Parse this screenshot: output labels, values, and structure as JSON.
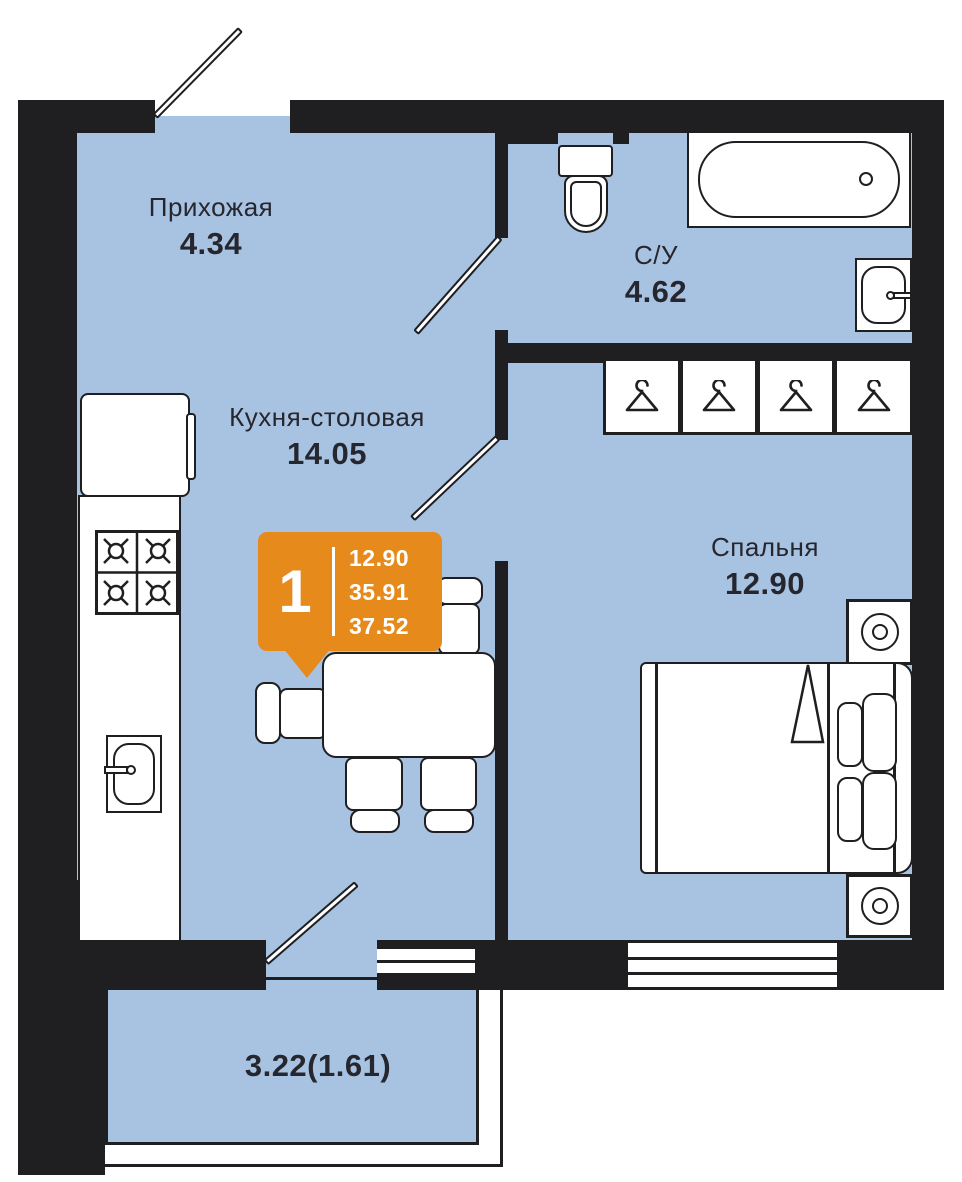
{
  "badge": {
    "rooms_count": "1",
    "values": [
      "12.90",
      "35.91",
      "37.52"
    ]
  },
  "rooms": {
    "hallway": {
      "name": "Прихожая",
      "area": "4.34"
    },
    "kitchen": {
      "name": "Кухня-столовая",
      "area": "14.05"
    },
    "bathroom": {
      "name": "С/У",
      "area": "4.62"
    },
    "bedroom": {
      "name": "Спальня",
      "area": "12.90"
    },
    "balcony": {
      "area": "3.22(1.61)"
    }
  },
  "colors": {
    "floor": "#A8C3E2",
    "wall": "#1F1F22",
    "accent": "#E68A1C",
    "text": "#26262E",
    "fixture": "#FFFFFF"
  }
}
